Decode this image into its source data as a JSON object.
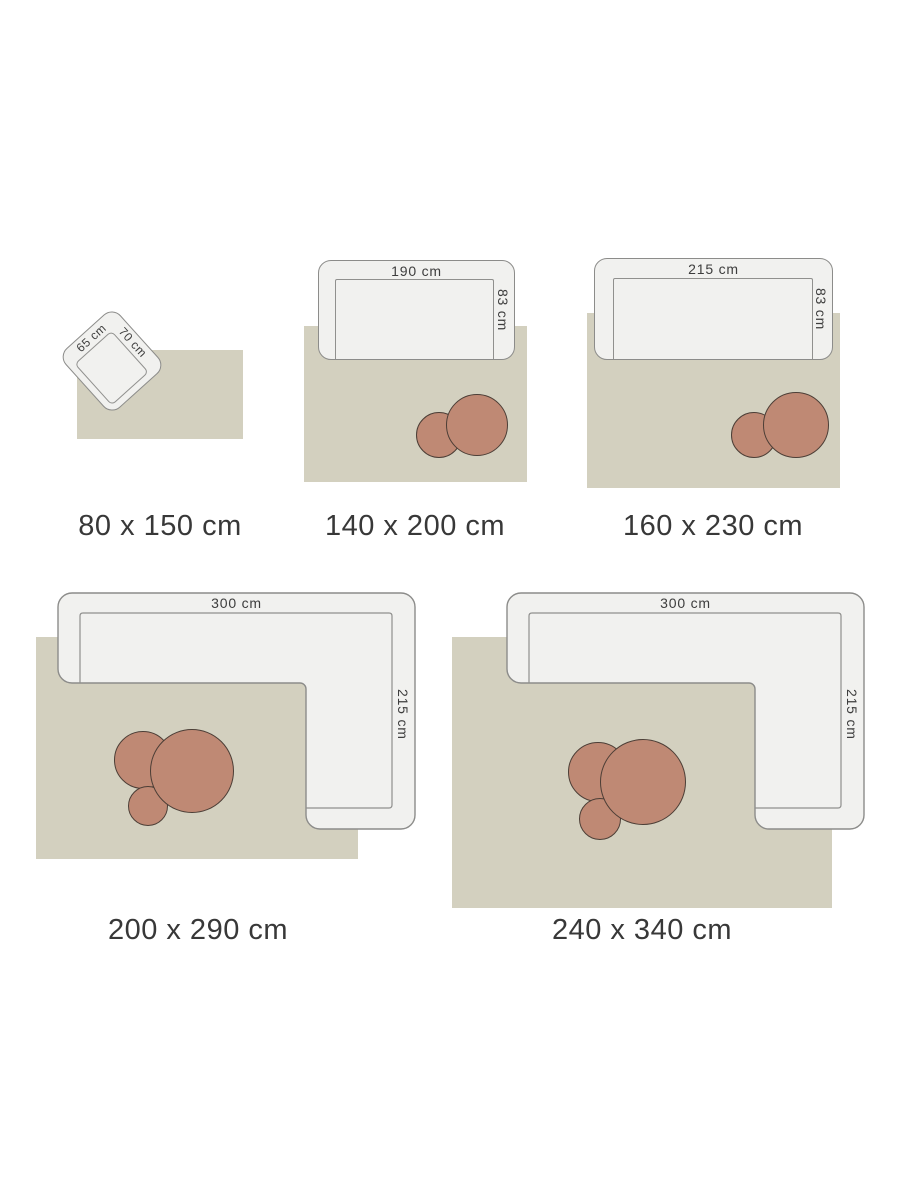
{
  "illustration": {
    "type": "rug-size-guide"
  },
  "colors": {
    "rug_fill": "#d3d0bf",
    "sofa_fill": "#f1f1ef",
    "sofa_border": "#8c8c8a",
    "seat_border": "#90908e",
    "table_fill": "#bf8974",
    "table_border": "#4c3e36",
    "label_dark": "#383838",
    "label_dim": "#3d3d3d"
  },
  "cards": [
    {
      "size_label": "80 x 150 cm",
      "furniture": {
        "kind": "armchair",
        "width_label": "65 cm",
        "depth_label": "70 cm"
      },
      "side_tables": 0
    },
    {
      "size_label": "140 x 200 cm",
      "furniture": {
        "kind": "sofa",
        "width_label": "190 cm",
        "depth_label": "83 cm"
      },
      "side_tables": 2
    },
    {
      "size_label": "160 x 230 cm",
      "furniture": {
        "kind": "sofa",
        "width_label": "215 cm",
        "depth_label": "83 cm"
      },
      "side_tables": 2
    },
    {
      "size_label": "200 x 290 cm",
      "furniture": {
        "kind": "corner-sofa",
        "width_label": "300 cm",
        "depth_label": "215 cm"
      },
      "side_tables": 3
    },
    {
      "size_label": "240 x 340 cm",
      "furniture": {
        "kind": "corner-sofa",
        "width_label": "300 cm",
        "depth_label": "215 cm"
      },
      "side_tables": 3
    }
  ]
}
